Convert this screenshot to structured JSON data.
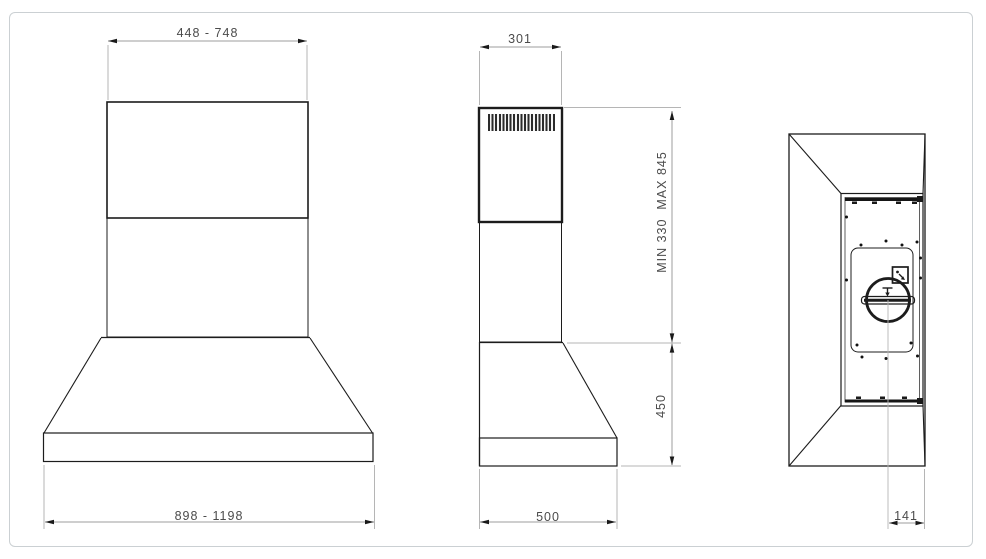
{
  "dimensions": {
    "front_chimney_width_range": "448 - 748",
    "front_body_width_range": "898 - 1198",
    "side_chimney_depth": "301",
    "side_chimney_height_range": "MIN 330  MAX 845",
    "side_canopy_height": "450",
    "side_body_depth": "500",
    "top_outlet_center_to_back": "141"
  },
  "colors": {
    "object_line": "#1c1c1c",
    "dimension_line": "#9e9e9e",
    "extension_line": "#b5b5b5",
    "dimension_text": "#4b4b4b",
    "page_border": "#cbd0d3",
    "background": "#ffffff"
  }
}
